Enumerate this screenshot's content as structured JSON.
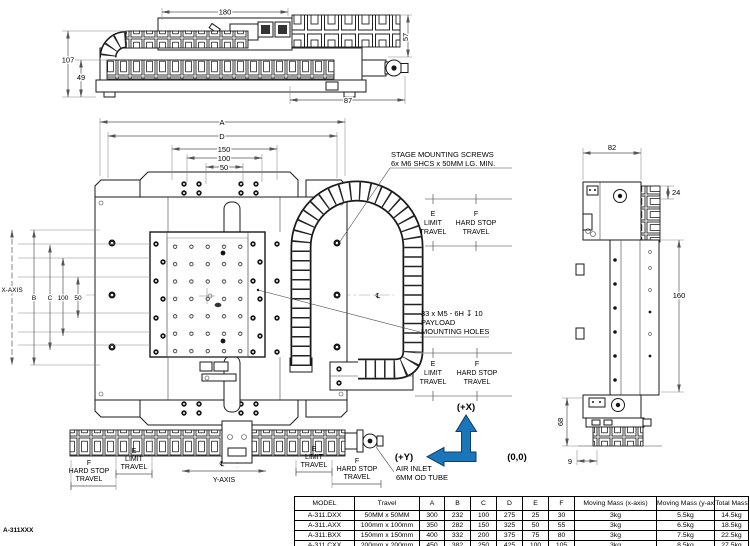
{
  "drawing": {
    "part_number": "A-311XXX",
    "colors": {
      "accent_blue": "#1b75bb",
      "line": "#1a1a1a",
      "dim_gray": "#555555"
    },
    "axes": {
      "plus_x": "(+X)",
      "plus_y": "(+Y)",
      "origin": "(0,0)",
      "x_axis": "X-AXIS",
      "y_axis": "Y-AXIS",
      "centerline": "℄"
    },
    "travel": {
      "e": "E",
      "e1": "LIMIT",
      "e2": "TRAVEL",
      "f": "F",
      "f1": "HARD STOP",
      "f2": "TRAVEL"
    },
    "notes": {
      "screws1": "STAGE MOUNTING SCREWS",
      "screws2": "6x M6 SHCS x 50MM LG. MIN.",
      "payload1": "33 x M5 - 6H ↧ 10",
      "payload2": "PAYLOAD",
      "payload3": "MOUNTING HOLES",
      "air1": "AIR INLET",
      "air2": "6MM OD TUBE"
    },
    "dims": {
      "front": {
        "w180": "180",
        "h107": "107",
        "h49": "49",
        "w87": "87",
        "h57": "57"
      },
      "plan_top": {
        "a": "A",
        "d": "D",
        "w150": "150",
        "w100": "100",
        "w50": "50"
      },
      "plan_left": {
        "b": "B",
        "c": "C",
        "h100": "100",
        "h50": "50"
      },
      "side": {
        "w82": "82",
        "h24": "24",
        "h160": "160",
        "h68": "68",
        "w9": "9"
      }
    }
  },
  "table": {
    "headers": [
      "MODEL",
      "Travel",
      "A",
      "B",
      "C",
      "D",
      "E",
      "F",
      "Moving Mass (x-axis)",
      "Moving Mass (y-axis)",
      "Total Mass"
    ],
    "rows": [
      [
        "A-311.DXX",
        "50MM x 50MM",
        "300",
        "232",
        "100",
        "275",
        "25",
        "30",
        "3kg",
        "5.5kg",
        "14.5kg"
      ],
      [
        "A-311.AXX",
        "100mm x 100mm",
        "350",
        "282",
        "150",
        "325",
        "50",
        "55",
        "3kg",
        "6.5kg",
        "18.5kg"
      ],
      [
        "A-311.BXX",
        "150mm x 150mm",
        "400",
        "332",
        "200",
        "375",
        "75",
        "80",
        "3kg",
        "7.5kg",
        "22.5kg"
      ],
      [
        "A-311.CXX",
        "200mm x 200mm",
        "450",
        "382",
        "250",
        "425",
        "100",
        "105",
        "3kg",
        "8.5kg",
        "27.5kg"
      ]
    ]
  }
}
